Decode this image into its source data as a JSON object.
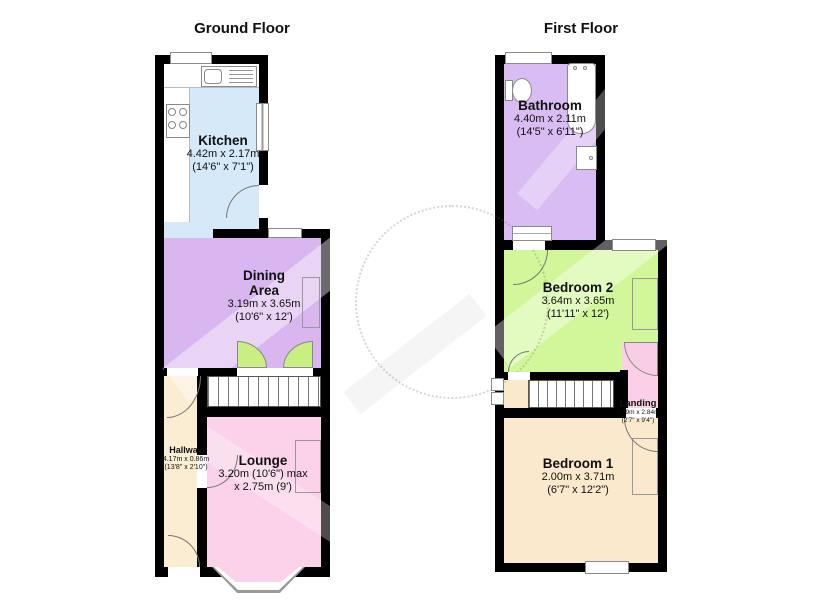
{
  "ground_floor": {
    "title": "Ground Floor",
    "rooms": {
      "kitchen": {
        "name": "Kitchen",
        "dim1": "4.42m x 2.17m",
        "dim2": "(14'6\" x 7'1\")"
      },
      "dining": {
        "name": "Dining Area",
        "dim1": "3.19m x 3.65m",
        "dim2": "(10'6\" x 12')"
      },
      "hallway": {
        "name": "Hallway",
        "dim1": "4.17m x 0.86m",
        "dim2": "(13'8\" x 2'10\")"
      },
      "lounge": {
        "name": "Lounge",
        "dim1": "3.20m (10'6\") max",
        "dim2": "x 2.75m (9')"
      }
    }
  },
  "first_floor": {
    "title": "First Floor",
    "rooms": {
      "bathroom": {
        "name": "Bathroom",
        "dim1": "4.40m x 2.11m",
        "dim2": "(14'5\" x 6'11\")"
      },
      "bedroom2": {
        "name": "Bedroom 2",
        "dim1": "3.64m x 3.65m",
        "dim2": "(11'11\" x 12')"
      },
      "landing": {
        "name": "Landing",
        "dim1": "0.79m x 2.84m",
        "dim2": "(2'7\" x 9'4\")"
      },
      "bedroom1": {
        "name": "Bedroom 1",
        "dim1": "2.00m x 3.71m",
        "dim2": "(6'7\" x 12'2\")"
      }
    }
  },
  "colors": {
    "wall": "#000000",
    "kitchen": "#d6e9f8",
    "dining": "#d9b6f0",
    "bathroom": "#dabcf4",
    "bedroom2": "#d2f79b",
    "lounge": "#fbd2e9",
    "landing": "#fbcfe6",
    "hallway": "#fbedd2",
    "bedroom1": "#fbe9cd",
    "door_green": "#c9ef83",
    "door_pink": "#f9cde4",
    "fixture_outline": "#8a8a8a"
  }
}
